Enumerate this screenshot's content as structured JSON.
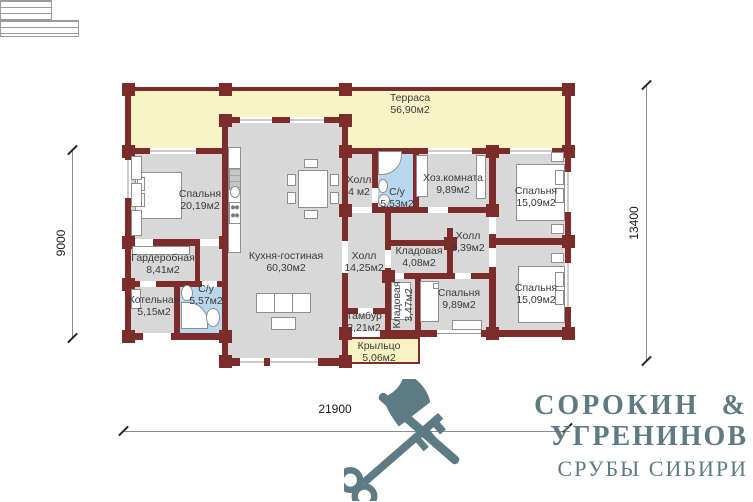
{
  "plan": {
    "rooms": [
      {
        "name": "Терраса",
        "area": "56,90м2"
      },
      {
        "name": "Спальня",
        "area": "20,19м2"
      },
      {
        "name": "Гардеробная",
        "area": "8,41м2"
      },
      {
        "name": "Котельная",
        "area": "5,15м2"
      },
      {
        "name": "С/у",
        "area": "5,57м2"
      },
      {
        "name": "Кухня-гостиная",
        "area": "60,30м2"
      },
      {
        "name": "Холл",
        "area": "4 м2"
      },
      {
        "name": "С/у",
        "area": "5,53м2"
      },
      {
        "name": "Хоз.комната",
        "area": "9,89м2"
      },
      {
        "name": "Спальня",
        "area": "15,09м2"
      },
      {
        "name": "Холл",
        "area": "14,25м2"
      },
      {
        "name": "Кладовая",
        "area": "4,08м2"
      },
      {
        "name": "Холл",
        "area": "5,39м2"
      },
      {
        "name": "Кладовая",
        "area": "3,47м2"
      },
      {
        "name": "Спальня",
        "area": "9,89м2"
      },
      {
        "name": "Спальня",
        "area": "15,09м2"
      },
      {
        "name": "Тамбур",
        "area": "2,21м2"
      },
      {
        "name": "Крыльцо",
        "area": "5,06м2"
      }
    ],
    "dimensions": {
      "left": "9000",
      "right": "13400",
      "bottom": "21900"
    }
  },
  "brand": {
    "line1": "СОРОКИН &",
    "line2": "УГРЕНИНОВ",
    "line3": "СРУБЫ СИБИРИ"
  },
  "colors": {
    "wall": "#7c2d2b",
    "room": "#d8d8d8",
    "terrace": "#f8f4c6",
    "bathroom": "#b9d8ee",
    "logo": "#5e7b83"
  }
}
